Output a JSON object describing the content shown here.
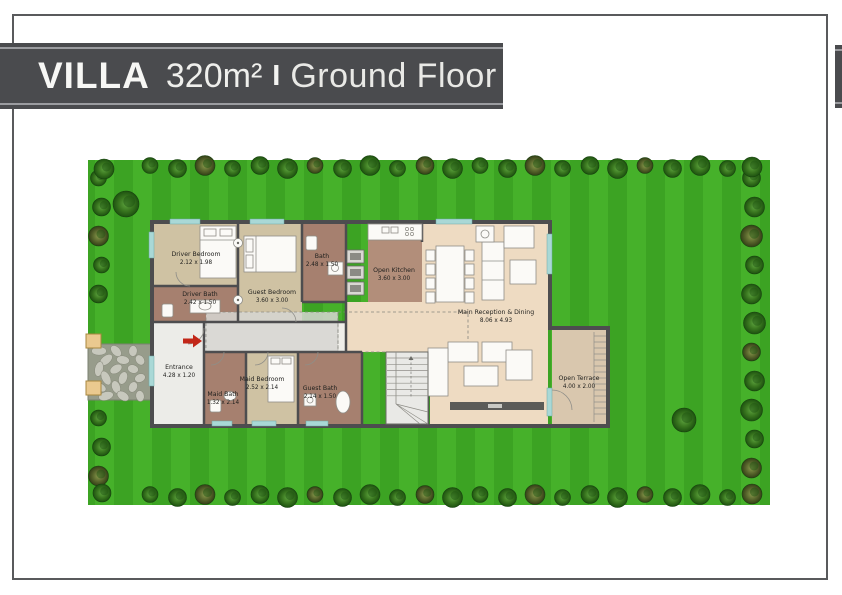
{
  "banner": {
    "villa": "VILLA",
    "area": "320m²",
    "separator": "I",
    "floor": "Ground Floor"
  },
  "plan": {
    "rooms": [
      {
        "name": "Driver Bedroom",
        "dims": "2.12 x 1.98"
      },
      {
        "name": "Driver Bath",
        "dims": "2.42 x 1.50"
      },
      {
        "name": "Guest Bedroom",
        "dims": "3.60 x 3.00"
      },
      {
        "name": "Bath",
        "dims": "2.48 x 1.50"
      },
      {
        "name": "Open Kitchen",
        "dims": "3.60 x 3.00"
      },
      {
        "name": "Main Reception & Dining",
        "dims": "8.06 x 4.93"
      },
      {
        "name": "Entrance",
        "dims": "4.28 x 1.20"
      },
      {
        "name": "Maid Bath",
        "dims": "1.32 x 2.14"
      },
      {
        "name": "Maid Bedroom",
        "dims": "2.52 x 2.14"
      },
      {
        "name": "Guest Bath",
        "dims": "2.14 x 1.50"
      },
      {
        "name": "Open Terrace",
        "dims": "4.00 x 2.00"
      }
    ],
    "colors": {
      "banner_bg": "#4a4b4e",
      "banner_text": "#f4f4f2",
      "frame_border": "#595a5c",
      "lawn_light": "#46b12a",
      "lawn_dark": "#3ca323",
      "tree_green": "#1d5212",
      "wall": "#4d4d4f",
      "bedroom_fill": "#cfc2a3",
      "bath_fill": "#a6806f",
      "kitchen_fill": "#b28e7a",
      "reception_fill": "#eedbc2",
      "terrace_fill": "#d9c7ae",
      "window_glass": "#a9d8d6",
      "entrance_arrow": "#c22718"
    }
  }
}
